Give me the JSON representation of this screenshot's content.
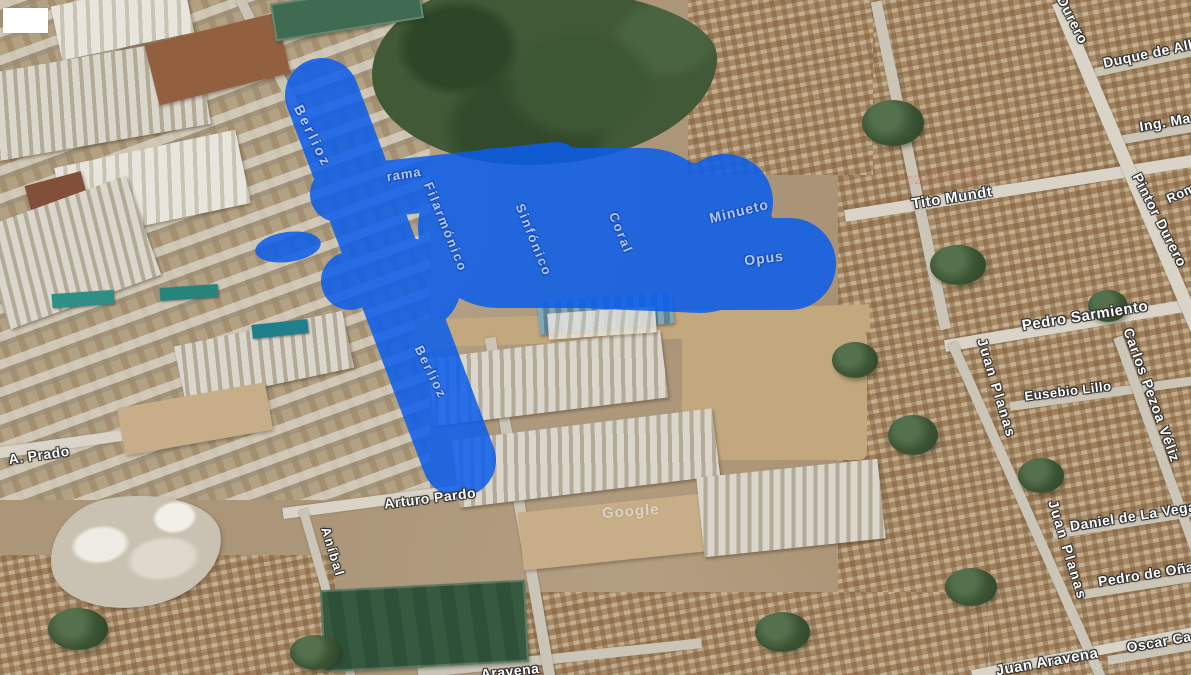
{
  "map_type": "satellite",
  "overlay": {
    "name": "highlighted-region",
    "highlight_color": "#0a5ded",
    "highlight_opacity": 0.85
  },
  "watermarks": {
    "google_logo": "Google",
    "imagery_copyright_top": "©2023 Google",
    "imagery_copyright_bottom": "©2023 Google"
  },
  "street_labels": [
    {
      "text": "Berlioz",
      "x": 313,
      "y": 136,
      "r": 64,
      "s": 14,
      "ls": 3,
      "v": "overlay"
    },
    {
      "text": "Berlioz",
      "x": 431,
      "y": 372,
      "r": 64,
      "s": 13,
      "ls": 2,
      "v": "overlay"
    },
    {
      "text": "rama",
      "x": 404,
      "y": 174,
      "r": -9,
      "s": 13,
      "ls": 1,
      "v": "overlay"
    },
    {
      "text": "Filarmónico",
      "x": 446,
      "y": 227,
      "r": 68,
      "s": 13,
      "ls": 2,
      "v": "overlay"
    },
    {
      "text": "Sinfónico",
      "x": 534,
      "y": 240,
      "r": 68,
      "s": 13,
      "ls": 2,
      "v": "overlay"
    },
    {
      "text": "Coral",
      "x": 621,
      "y": 233,
      "r": 68,
      "s": 13,
      "ls": 2,
      "v": "overlay"
    },
    {
      "text": "Minueto",
      "x": 739,
      "y": 211,
      "r": -14,
      "s": 14,
      "ls": 1,
      "v": "overlay"
    },
    {
      "text": "Opus",
      "x": 764,
      "y": 258,
      "r": -7,
      "s": 14,
      "ls": 1,
      "v": "overlay"
    },
    {
      "text": "Tito Mundt",
      "x": 952,
      "y": 198,
      "r": -9,
      "s": 15,
      "ls": 0.5
    },
    {
      "text": "Pedro Sarmiento",
      "x": 1085,
      "y": 316,
      "r": -9,
      "s": 15,
      "ls": 0.5
    },
    {
      "text": "Carlos Pezoa Véliz",
      "x": 1152,
      "y": 395,
      "r": 70,
      "s": 14,
      "ls": 1
    },
    {
      "text": "Juan Planas",
      "x": 997,
      "y": 388,
      "r": 73,
      "s": 14,
      "ls": 2
    },
    {
      "text": "Eusebio Lillo",
      "x": 1068,
      "y": 391,
      "r": -7,
      "s": 13,
      "ls": 0.5
    },
    {
      "text": "A. Prado",
      "x": 39,
      "y": 455,
      "r": -8,
      "s": 14,
      "ls": 0.5
    },
    {
      "text": "Arturo Pardo",
      "x": 430,
      "y": 498,
      "r": -7,
      "s": 14,
      "ls": 0.5
    },
    {
      "text": "Aníbal",
      "x": 333,
      "y": 552,
      "r": 73,
      "s": 13,
      "ls": 2
    },
    {
      "text": "Daniel de La Vega",
      "x": 1133,
      "y": 516,
      "r": -9,
      "s": 14,
      "ls": 0.5
    },
    {
      "text": "Juan Planas",
      "x": 1068,
      "y": 550,
      "r": 73,
      "s": 14,
      "ls": 2
    },
    {
      "text": "Pedro de Oña",
      "x": 1146,
      "y": 574,
      "r": -9,
      "s": 14,
      "ls": 0.5
    },
    {
      "text": "Oscar Cas",
      "x": 1163,
      "y": 641,
      "r": -10,
      "s": 14,
      "ls": 0.5
    },
    {
      "text": "Juan Aravena",
      "x": 1047,
      "y": 662,
      "r": -10,
      "s": 15,
      "ls": 0.5
    },
    {
      "text": "Aravena",
      "x": 510,
      "y": 671,
      "r": -6,
      "s": 14,
      "ls": 0.5
    },
    {
      "text": "Durero",
      "x": 1073,
      "y": 20,
      "r": 63,
      "s": 14,
      "ls": 1
    },
    {
      "text": "Duque de Alb",
      "x": 1150,
      "y": 53,
      "r": -12,
      "s": 14,
      "ls": 0.5
    },
    {
      "text": "Ing. Ma",
      "x": 1165,
      "y": 122,
      "r": -10,
      "s": 14,
      "ls": 0.5
    },
    {
      "text": "Pintor Durero",
      "x": 1160,
      "y": 220,
      "r": 63,
      "s": 14,
      "ls": 1
    },
    {
      "text": "Rom",
      "x": 1181,
      "y": 193,
      "r": -25,
      "s": 13,
      "ls": 0.5
    }
  ]
}
